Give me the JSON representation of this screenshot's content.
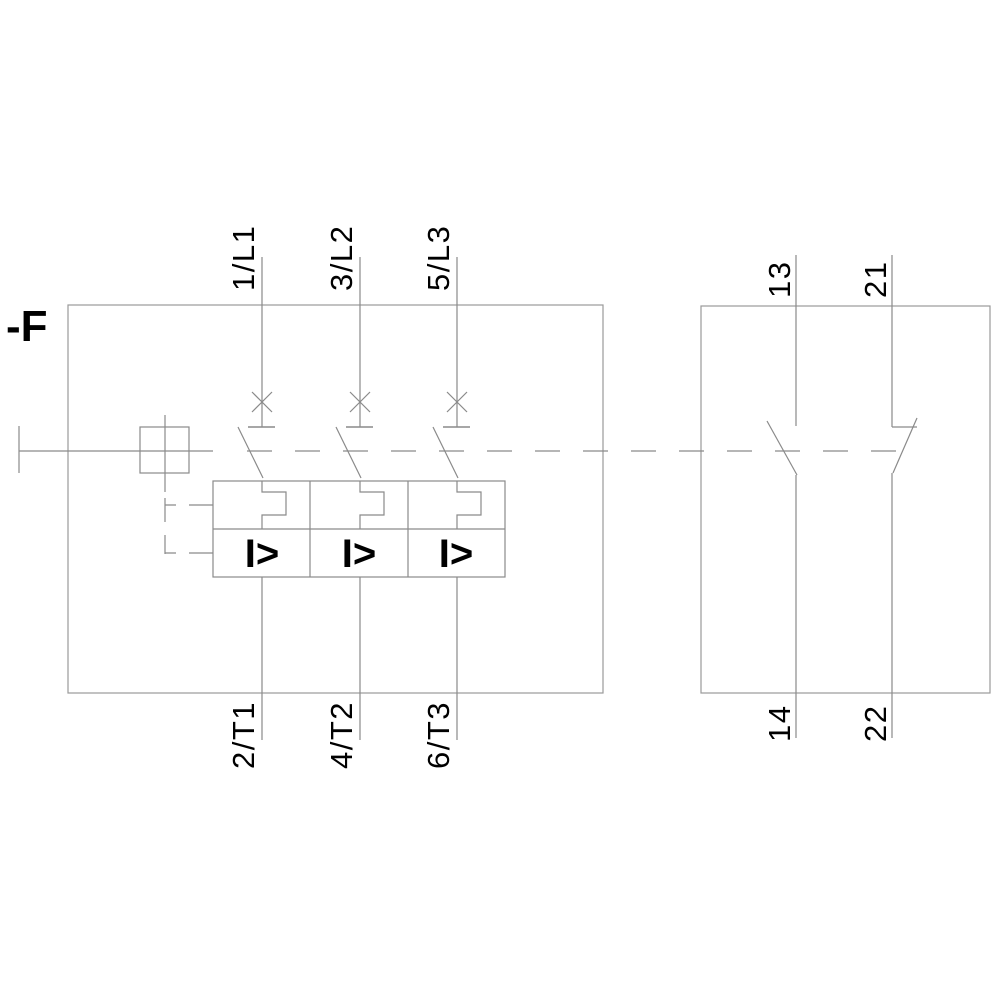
{
  "device": {
    "reference": "-F"
  },
  "main_breaker": {
    "line_terminals": [
      "1/L1",
      "3/L2",
      "5/L3"
    ],
    "load_terminals": [
      "2/T1",
      "4/T2",
      "6/T3"
    ],
    "overcurrent_symbol": "I>"
  },
  "aux_contacts": {
    "no_top": "13",
    "no_bottom": "14",
    "nc_top": "21",
    "nc_bottom": "22"
  },
  "colors": {
    "line": "#8a8a8a",
    "text": "#000000",
    "background": "#ffffff"
  }
}
